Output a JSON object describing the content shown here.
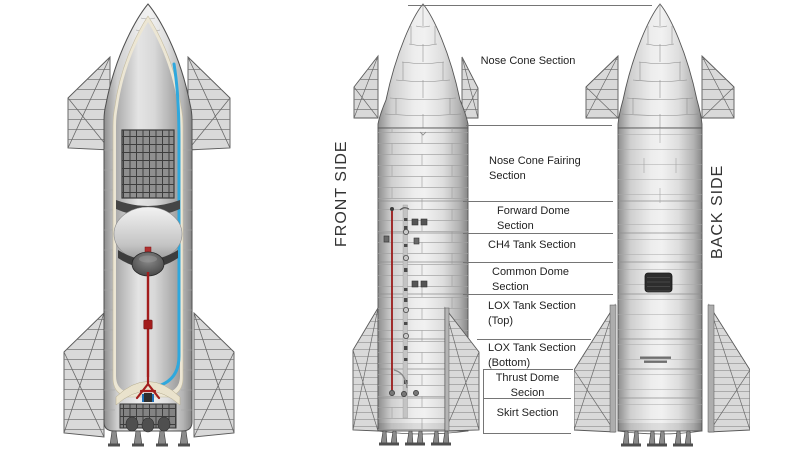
{
  "diagram": {
    "front_side_label": "FRONT SIDE",
    "back_side_label": "BACK SIDE",
    "sections": [
      {
        "label": "Nose Cone Section"
      },
      {
        "label": "Nose Cone Fairing Section"
      },
      {
        "label": "Forward Dome Section"
      },
      {
        "label": "CH4 Tank Section"
      },
      {
        "label": "Common Dome Section"
      },
      {
        "label": "LOX Tank Section (Top)"
      },
      {
        "label": "LOX Tank Section (Bottom)"
      },
      {
        "label": "Thrust Dome Secion"
      },
      {
        "label": "Skirt Section"
      }
    ],
    "colors": {
      "blue_transfer_tube": "#2fa8dd",
      "red_fuel_line": "#a31d1d",
      "divider_line": "#757575",
      "label_text": "#222222"
    }
  }
}
